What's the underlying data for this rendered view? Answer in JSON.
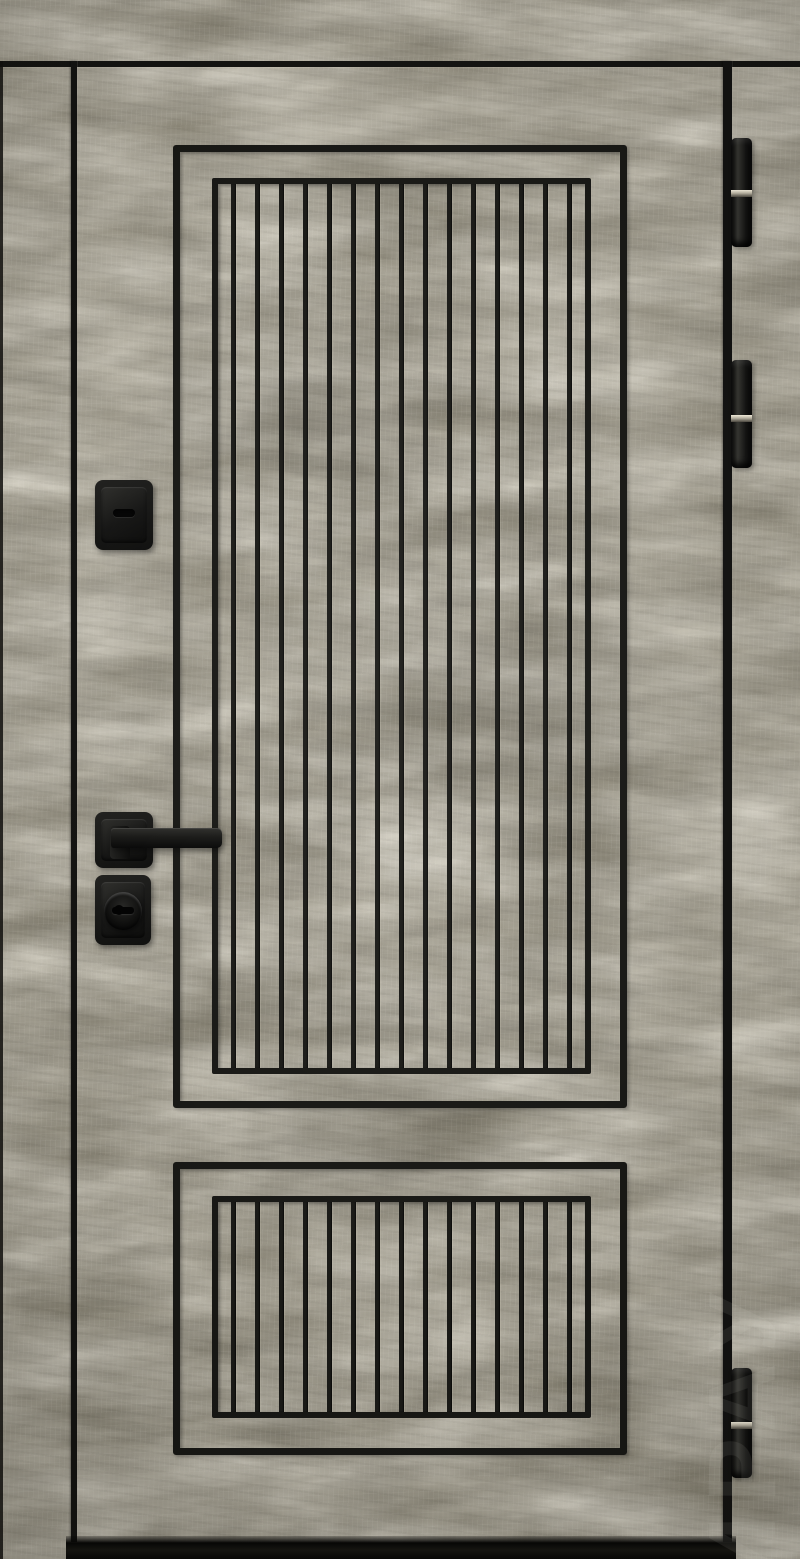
{
  "scene": {
    "type": "product-photo",
    "subject": "entry door with gray-olive woodgrain finish, two black slatted inset panels and black hardware"
  },
  "palette": {
    "wood_base": "#7e7969",
    "wood_highlight": "#cfc9b6",
    "wood_shadow": "#4e4a3e",
    "milling_black": "#171714",
    "hardware_black": "#141413",
    "hinge_ring_silver": "#d8d2c2",
    "threshold_black": "#0a0a09"
  },
  "door": {
    "panels": {
      "upper": {
        "slat_count": 15
      },
      "lower": {
        "slat_count": 15
      }
    },
    "hardware": {
      "hinges": {
        "count": 3,
        "positions": [
          "top",
          "middle",
          "bottom"
        ]
      },
      "thumbturn": "square black thumbturn escutcheon",
      "lever_handle": "square-rosette black lever handle",
      "key_cylinder": "square black escutcheon with round key cylinder"
    }
  },
  "watermark": {
    "text": "ИРАУ"
  }
}
